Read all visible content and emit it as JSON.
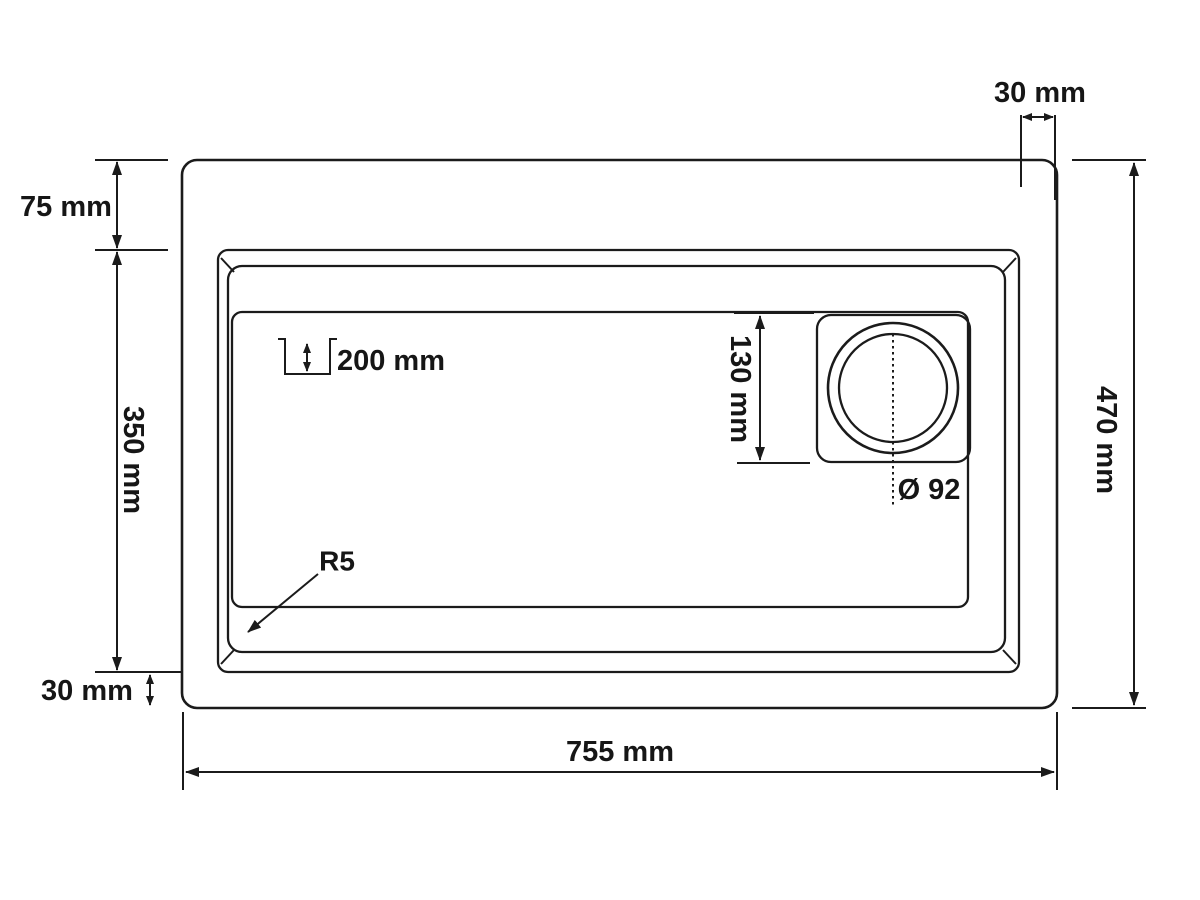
{
  "drawing": {
    "type": "sink-dimension-diagram",
    "colors": {
      "line": "#1b1b1b",
      "background": "#ffffff"
    },
    "dimensions": {
      "top_rim_clearance": "30 mm",
      "top_ledge": "75 mm",
      "bowl_side_length": "350 mm",
      "bottom_rim_clearance": "30 mm",
      "overall_width": "755 mm",
      "overall_depth": "470 mm",
      "drain_inset": "130 mm",
      "bowl_depth": "200 mm",
      "drain_diameter": "Ø 92",
      "corner_radius": "R5"
    }
  }
}
